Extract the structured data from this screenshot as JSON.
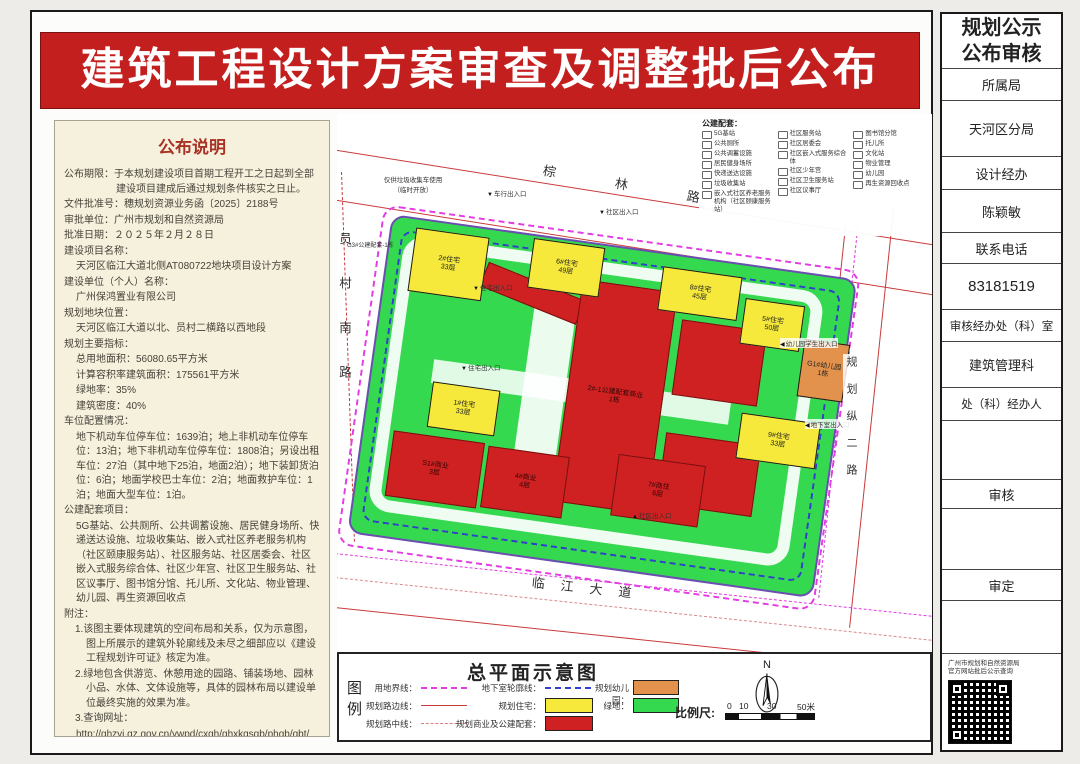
{
  "title": "建筑工程设计方案审查及调整批后公布",
  "colors": {
    "banner_red": "#c41f1f",
    "residential_yellow": "#f6e93c",
    "commercial_red": "#cf2121",
    "kindergarten_orange": "#e2924d",
    "greenery": "#35d94f",
    "boundary_magenta": "#e23ce2",
    "basement_blue": "#3040cc",
    "road_red": "#c83a3a",
    "notice_bg": "#f6f1dc"
  },
  "notice": {
    "heading": "公布说明",
    "lines": [
      "公布期限：于本规划建设项目首期工程开工之日起到全部建设项目建成后通过规划条件核实之日止。",
      "文件批准号：穗规划资源业务函〔2025〕2188号",
      "审批单位：广州市规划和自然资源局",
      "批准日期：２０２５年２月２８日",
      "建设项目名称：",
      "天河区临江大道北侧AT080722地块项目设计方案",
      "建设单位（个人）名称：",
      "广州保鸿置业有限公司",
      "规划地块位置：",
      "天河区临江大道以北、员村二横路以西地段",
      "规划主要指标：",
      "总用地面积：56080.65平方米",
      "计算容积率建筑面积：175561平方米",
      "绿地率：35%",
      "建筑密度：40%",
      "车位配置情况：",
      "地下机动车位停车位：1639泊；地上非机动车位停车位：13泊；地下非机动车位停车位：1808泊；另设出租车位：27泊（其中地下25泊，地面2泊）；地下装卸货泊位：6泊；地面学校巴士车位：2泊；地面救护车位：1泊；地面大型车位：1泊。",
      "公建配套项目：",
      "5G基站、公共厕所、公共调蓄设施、居民健身场所、快递送达设施、垃圾收集站、嵌入式社区养老服务机构（社区颐康服务站）、社区服务站、社区居委会、社区嵌入式服务综合体、社区少年宫、社区卫生服务站、社区议事厅、图书馆分馆、托儿所、文化站、物业管理、幼儿园、再生资源回收点",
      "附注：",
      "1.该图主要体现建筑的空间布局和关系，仅为示意图，图上所展示的建筑外轮廓线及未尽之细部应以《建设工程规划许可证》核定为准。",
      "2.绿地包含供游览、休憩用途的园路、铺装场地、园林小品、水体、文体设施等，具体的园林布局以建设单位最终实施的效果为准。",
      "3.查询网址：",
      "http://ghzyj.gz.gov.cn/ywpd/cxgh/ghxkgsgb/phgb/gbt/"
    ]
  },
  "map": {
    "roads": {
      "north": "棕林路",
      "west": "员村南路",
      "east": "规划纵二路",
      "south": "临江大道"
    },
    "pubfac": {
      "title": "公建配套：",
      "col1": [
        "5G基站",
        "公共厕所",
        "公共调蓄设施",
        "居民健身场所",
        "快递送达设施",
        "垃圾收集站",
        "嵌入式社区养老服务机构（社区颐康服务站）"
      ],
      "col2": [
        "社区服务站",
        "社区居委会",
        "社区嵌入式服务综合体",
        "社区少年宫",
        "社区卫生服务站",
        "社区议事厅"
      ],
      "col3": [
        "图书馆分馆",
        "托儿所",
        "文化站",
        "物业管理",
        "幼儿园",
        "再生资源回收点"
      ]
    },
    "buildings": [
      {
        "label": "2#住宅\n33层"
      },
      {
        "label": "6#住宅\n49层"
      },
      {
        "label": "8#住宅\n45层"
      },
      {
        "label": "5#住宅\n50层"
      },
      {
        "label": "G1#幼儿园\n1栋"
      },
      {
        "label": "1#住宅\n33层"
      },
      {
        "label": "9#住宅\n33层"
      },
      {
        "label": "2#-1公建配套商业\n1栋"
      },
      {
        "label": "S1#商业\n3层"
      },
      {
        "label": "4#商业\n4层"
      },
      {
        "label": "7#商住\n6层"
      }
    ],
    "annotations": [
      "仅供垃圾收集车使用\n（临时开放）",
      "车行出入口",
      "社区出入口",
      "住宅出入口",
      "住宅出入口",
      "幼儿园学生出入口",
      "地下室出入口",
      "社区出入口",
      "G3#公建配套-1栋"
    ]
  },
  "legend": {
    "block_label": "图\n例",
    "title": "总平面示意图",
    "items": [
      {
        "label": "用地界线："
      },
      {
        "label": "规划路边线："
      },
      {
        "label": "规划路中线："
      },
      {
        "label": "地下室轮廓线："
      },
      {
        "label": "规划住宅："
      },
      {
        "label": "规划商业及公建配套："
      },
      {
        "label": "规划幼儿园："
      },
      {
        "label": "绿地："
      }
    ],
    "scale": {
      "label": "比例尺:",
      "ticks": [
        "0",
        "10",
        "30",
        "50米"
      ]
    },
    "north": "N"
  },
  "sidebar": {
    "title": "规划公示\n公布审核",
    "rows": [
      "所属局",
      "天河区分局",
      "设计经办",
      "陈颖敏",
      "联系电话",
      "83181519",
      "审核经办处（科）室",
      "建筑管理科",
      "处（科）经办人",
      "",
      "审核",
      "",
      "审定",
      ""
    ],
    "qr_caption": "广州市规划和自然资源局\n官方网站批后公示查询"
  }
}
